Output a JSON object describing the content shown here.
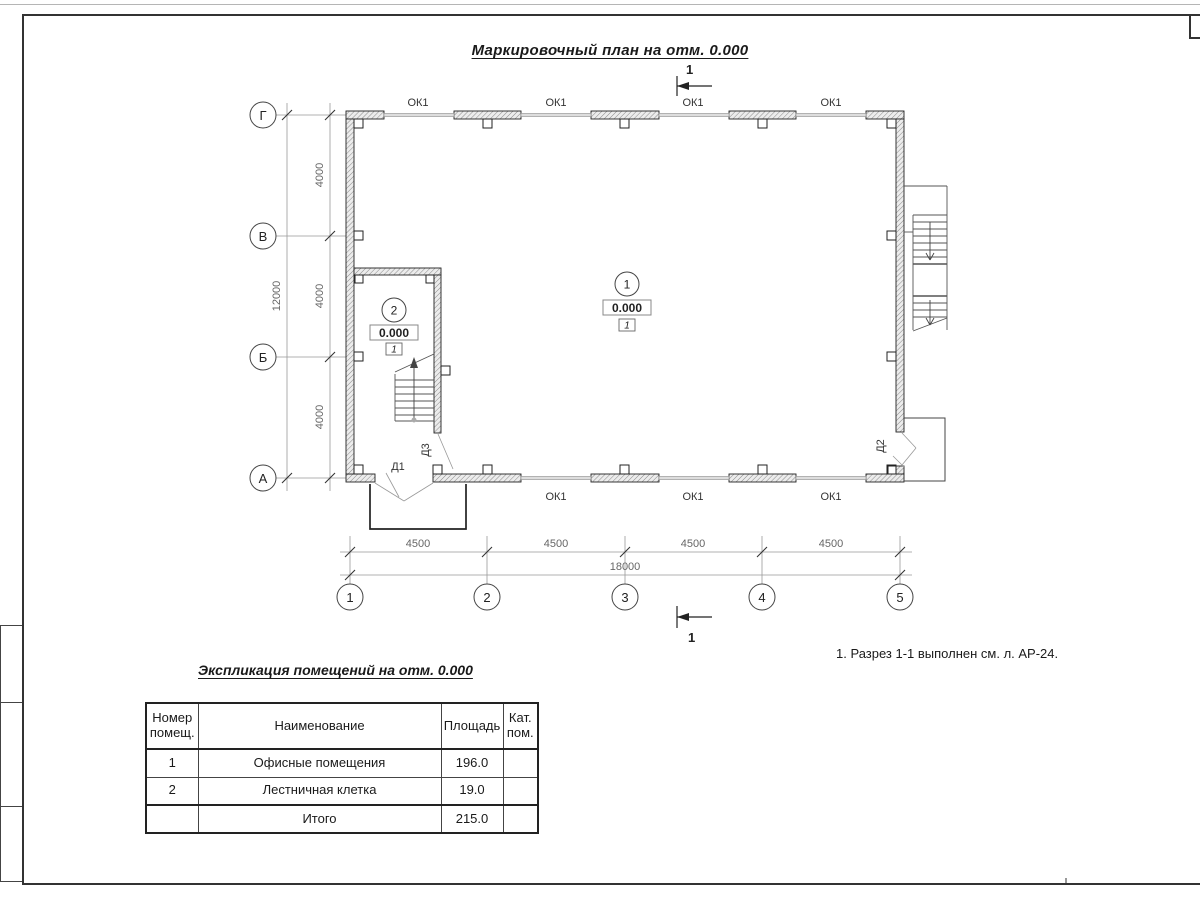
{
  "sheet": {
    "title": "Маркировочный план на отм. 0.000",
    "note": "1. Разрез 1-1 выполнен см. л. АР-24."
  },
  "plan": {
    "section_label": "1",
    "window_label": "ОК1",
    "doors": [
      "Д1",
      "Д2",
      "Д3"
    ],
    "axes": {
      "rows": [
        "Г",
        "В",
        "Б",
        "А"
      ],
      "cols": [
        "1",
        "2",
        "3",
        "4",
        "5"
      ]
    },
    "dims": {
      "left": [
        "4000",
        "4000",
        "4000"
      ],
      "left_total": "12000",
      "bottom": [
        "4500",
        "4500",
        "4500",
        "4500"
      ],
      "bottom_total": "18000"
    },
    "rooms": [
      {
        "number": "1",
        "elevation": "0.000",
        "floor_type": "1"
      },
      {
        "number": "2",
        "elevation": "0.000",
        "floor_type": "1"
      }
    ]
  },
  "schedule": {
    "title": "Экспликация помещений на отм. 0.000",
    "headers": [
      "Номер помещ.",
      "Наименование",
      "Площадь",
      "Кат. пом."
    ],
    "rows": [
      {
        "number": "1",
        "name": "Офисные помещения",
        "area": "196.0",
        "category": ""
      },
      {
        "number": "2",
        "name": "Лестничная клетка",
        "area": "19.0",
        "category": ""
      }
    ],
    "total_label": "Итого",
    "total_area": "215.0"
  }
}
